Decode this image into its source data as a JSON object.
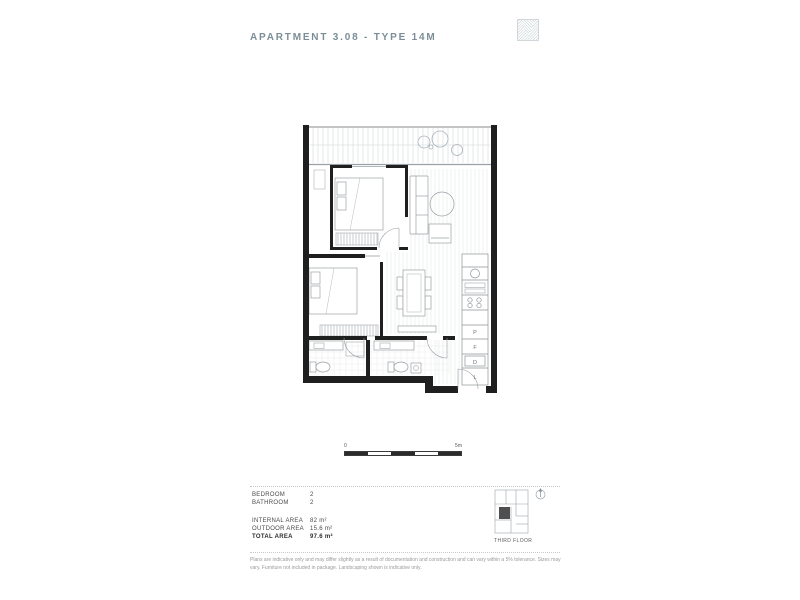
{
  "header": {
    "title": "APARTMENT 3.08 - TYPE 14M",
    "logo": "hatched-square-logo"
  },
  "colors": {
    "accent": "#7b8e97",
    "wall": "#1f1f1f",
    "furniture_line": "#9aa0a4",
    "floor_line": "#dfe2e4",
    "keyplan_highlight": "#4f4f4f"
  },
  "scale_bar": {
    "start_label": "0",
    "end_label": "5m"
  },
  "plan": {
    "kitchen_labels": [
      "P",
      "F",
      "D",
      "L"
    ]
  },
  "legend": {
    "rooms": [
      {
        "label": "BEDROOM",
        "value": "2"
      },
      {
        "label": "BATHROOM",
        "value": "2"
      }
    ],
    "areas": [
      {
        "label": "INTERNAL AREA",
        "value": "82 m²"
      },
      {
        "label": "OUTDOOR AREA",
        "value": "15.6 m²"
      },
      {
        "label": "TOTAL AREA",
        "value": "97.6 m²"
      }
    ]
  },
  "key_plan": {
    "floor_label": "THIRD FLOOR"
  },
  "disclaimer": {
    "text": "Plans are indicative only and may differ slightly as a result of documentation and construction and can vary within a 5% tolerance. Sizes may vary. Furniture not included in package. Landscaping shown is indicative only."
  }
}
